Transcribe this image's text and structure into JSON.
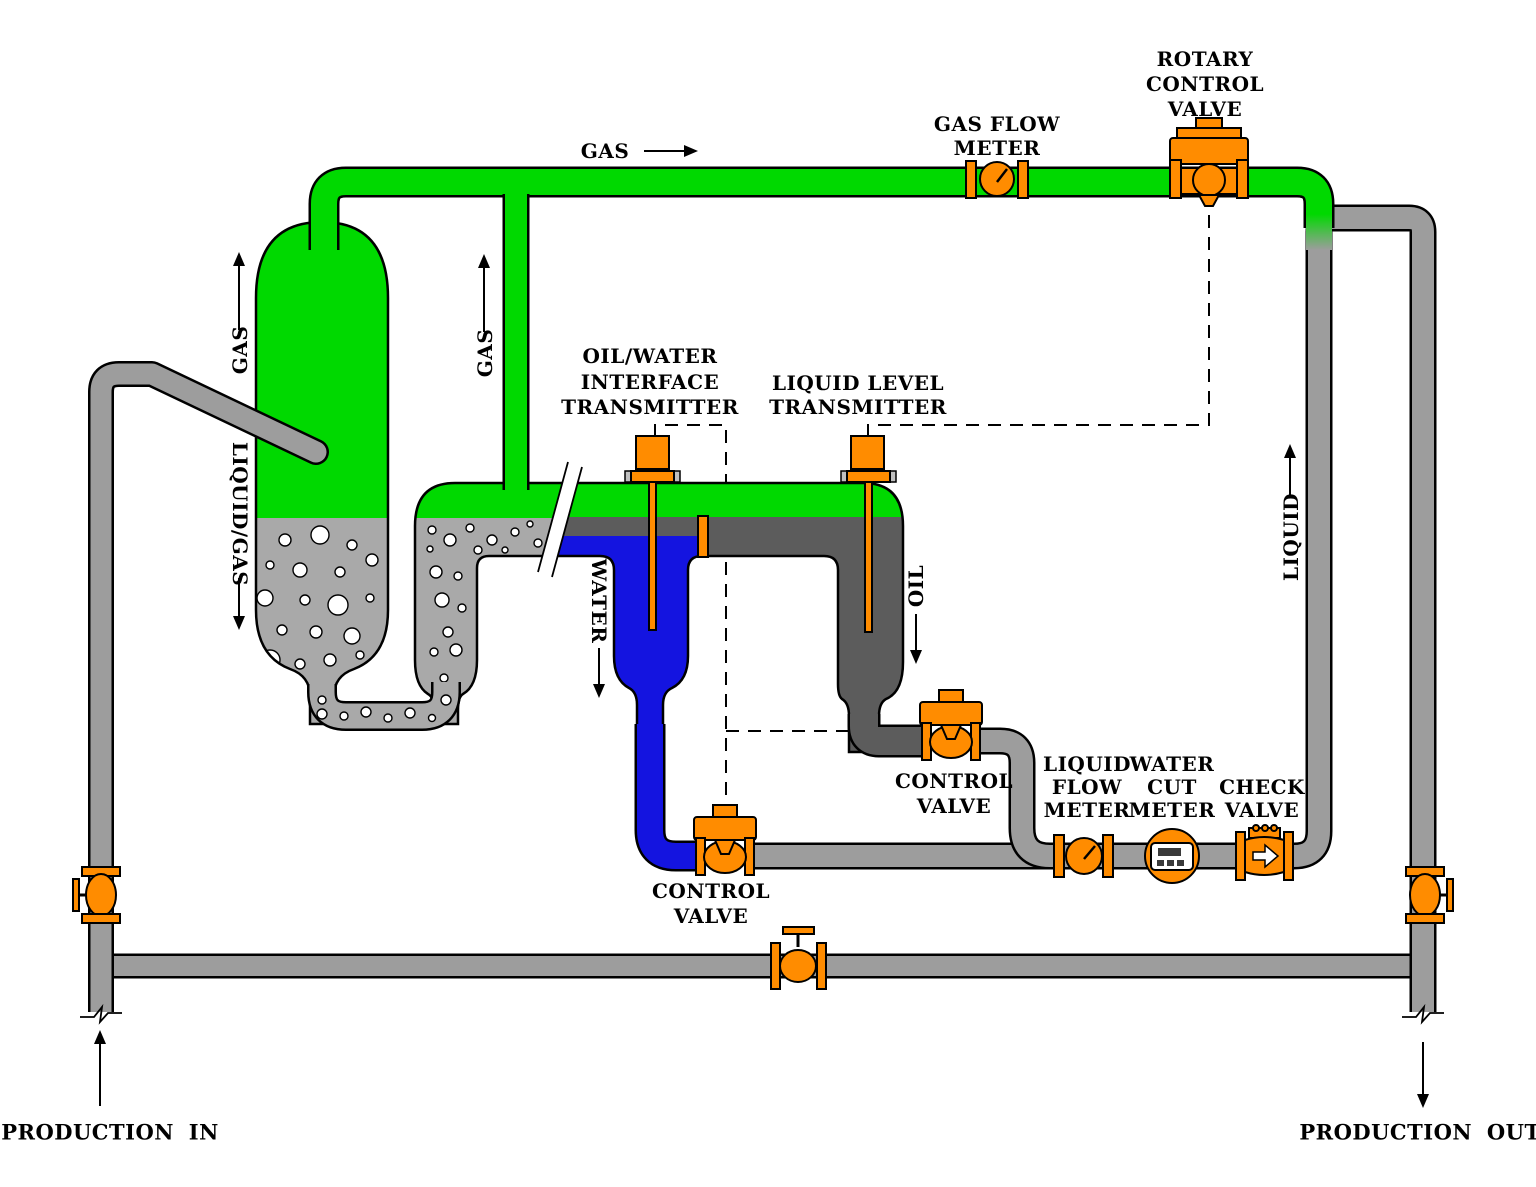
{
  "title": "Three-phase separator production flow diagram",
  "colors": {
    "gas": "#00d900",
    "pipe": "#9d9d9d",
    "bubbly": "#a9a9a9",
    "oil": "#5c5c5c",
    "water": "#1414e0",
    "equipment": "#ff8c00",
    "outline": "#000000"
  },
  "labels": {
    "gas_stream": "GAS",
    "rotary_control_valve": [
      "ROTARY",
      "CONTROL",
      "VALVE"
    ],
    "gas_flow_meter": [
      "GAS FLOW",
      "METER"
    ],
    "vessel_gas": "GAS",
    "vessel_liquid_gas": "LIQUID/GAS",
    "riser_gas": "GAS",
    "oil_water_interface_transmitter": [
      "OIL/WATER",
      "INTERFACE",
      "TRANSMITTER"
    ],
    "liquid_level_transmitter": [
      "LIQUID LEVEL",
      "TRANSMITTER"
    ],
    "water": "WATER",
    "oil": "OIL",
    "liquid": "LIQUID",
    "water_control_valve": [
      "CONTROL",
      "VALVE"
    ],
    "oil_control_valve": [
      "CONTROL",
      "VALVE"
    ],
    "liquid_flow_meter": [
      "LIQUID",
      "FLOW",
      "METER"
    ],
    "water_cut_meter": [
      "WATER",
      "CUT",
      "METER"
    ],
    "check_valve": [
      "CHECK",
      "VALVE"
    ],
    "production_in": "PRODUCTION IN",
    "production_out": "PRODUCTION OUT"
  }
}
